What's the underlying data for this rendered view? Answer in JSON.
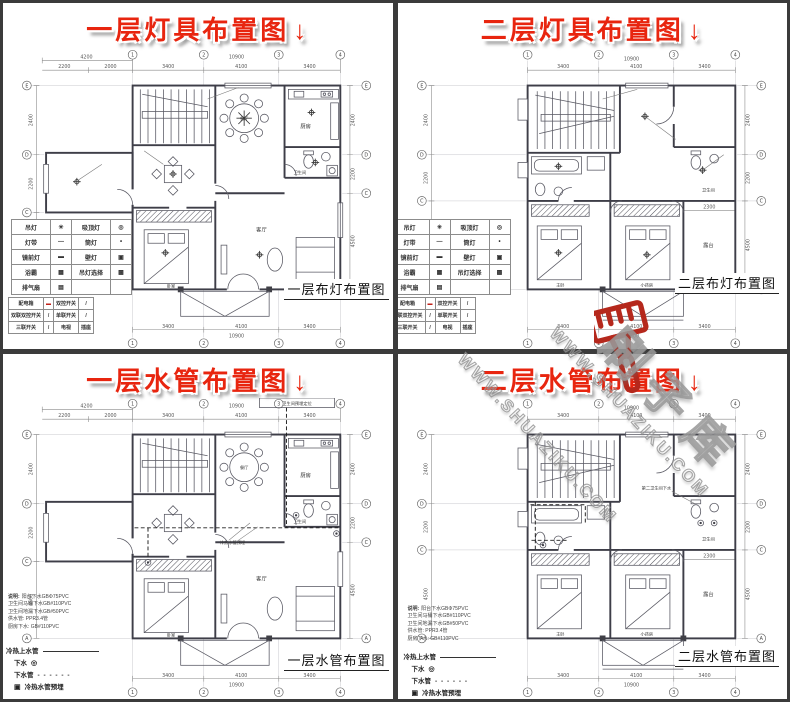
{
  "colors": {
    "title_red": "#e8250f",
    "frame": "#3b3b3b",
    "ink": "#444444",
    "watermark_red": "#b5281c"
  },
  "titles": {
    "tl": "一层灯具布置图",
    "tr": "二层灯具布置图",
    "bl": "一层水管布置图",
    "br": "二层水管布置图",
    "arrow": "↓"
  },
  "captions": {
    "tl": "一层布灯布置图",
    "tr": "二层布灯布置图",
    "bl": "一层水管布置图",
    "br": "二层水管布置图"
  },
  "floor1": {
    "top": {
      "wing": "4200",
      "wing_a": "2200",
      "wing_b": "2000",
      "d1": "3400",
      "d2": "4100",
      "d3": "3400",
      "total": "10900"
    },
    "bottom": {
      "d1": "3400",
      "d2": "4100",
      "d3": "3400",
      "total": "10900"
    },
    "side": {
      "r1": "2400",
      "r2": "2200",
      "r3": "4500"
    },
    "cols": [
      "1",
      "2",
      "3",
      "4"
    ],
    "rows": [
      "E",
      "D",
      "C",
      "A"
    ],
    "rooms": {
      "dining": "餐厅",
      "kitchen": "厨房",
      "bath": "卫生间",
      "living": "客厅",
      "bed": "卧室"
    }
  },
  "floor2": {
    "top": {
      "d1": "3400",
      "d2": "4100",
      "d3": "3400",
      "total": "10900"
    },
    "bottom": {
      "d1": "3400",
      "d2": "4100",
      "d3": "3400",
      "total": "10900"
    },
    "side": {
      "r1": "2400",
      "r2": "2200",
      "r3": "4500"
    },
    "terrace_dim": "2300",
    "cols": [
      "1",
      "2",
      "3",
      "4"
    ],
    "rows": [
      "E",
      "D",
      "C",
      "A"
    ],
    "rooms": {
      "master": "主卧",
      "kids": "小孩房",
      "terrace": "露台",
      "bath": "卫生间"
    }
  },
  "legend_light": {
    "rows": [
      [
        "吊灯",
        "✳",
        "吸顶灯",
        "◎"
      ],
      [
        "灯带",
        "—",
        "筒灯",
        "•"
      ],
      [
        "镜前灯",
        "▬",
        "壁灯",
        "▣"
      ],
      [
        "浴霸",
        "▦",
        "吊灯选择",
        "▩"
      ],
      [
        "排气扇",
        "▤",
        "",
        ""
      ]
    ]
  },
  "legend_switch": {
    "rows": [
      [
        "配电箱",
        "▬",
        "双控开关",
        "/"
      ],
      [
        "双联双控开关",
        "/",
        "单联开关",
        "/"
      ],
      [
        "三联开关",
        "/",
        "电视",
        "插座"
      ]
    ]
  },
  "plumbing": {
    "supply": "冷热上水管",
    "drain": "下水",
    "drain_sym": "◎",
    "drain_pipe": "下水管",
    "dash": "- - - - - -",
    "embed": "冷热水管预埋",
    "embed_sym": "▣",
    "box_note": "卫生间预埋定位",
    "note2": "第二卫生间下水",
    "center_note": "冷热水管预埋"
  },
  "notes": {
    "heading": "说明:",
    "lines": [
      "阳台下水GBΦ75PVC",
      "卫生间马桶下水GB#110PVC",
      "卫生间地漏下水GB#50PVC",
      "供水管: PPR3.4管",
      "厨房下水: GB#110PVC"
    ]
  },
  "watermark": {
    "brand": "刷子库",
    "url": "WWW.SHUAZIKU.COM"
  }
}
